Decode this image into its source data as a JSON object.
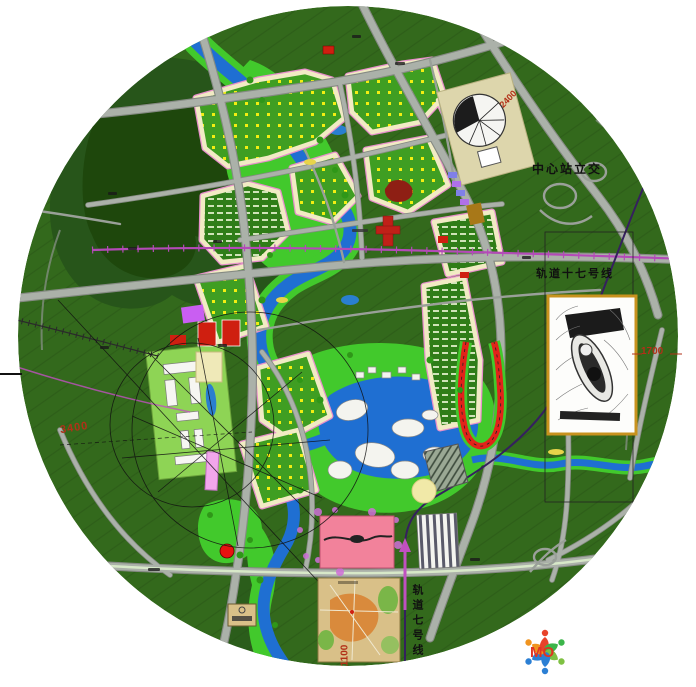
{
  "labels": {
    "interchange": "中心站立交",
    "rail_line_17": "轨道十七号线",
    "rail_line_7": "轨道七号线",
    "dim_right": "1700",
    "dim_bottom": "1100",
    "dim_left": "3400",
    "dim_north": "2400"
  },
  "logo": {
    "text": "MO",
    "text_color": "#e03422",
    "figure_colors": [
      "#2b7fd4",
      "#f0941f",
      "#e8432a",
      "#3bb54a",
      "#7fc143",
      "#2b7fd4"
    ]
  },
  "colors": {
    "base_green": "#33691c",
    "forest_dark": "#27551a",
    "park_green": "#42c92c",
    "water_blue": "#1f6fd2",
    "road_gray": "#abb1a9",
    "rail_magenta": "#b44ab8",
    "rail_dark_purple": "#35205e",
    "residential_cream": "#f1ebc4",
    "zone_pink_edge": "#e78fcb",
    "commercial_pink": "#f2829b",
    "red_accent": "#d42020",
    "dim_red": "#b23018",
    "inset_frame_gold": "#c8921e",
    "plaza_beige": "#ddd6ac"
  }
}
